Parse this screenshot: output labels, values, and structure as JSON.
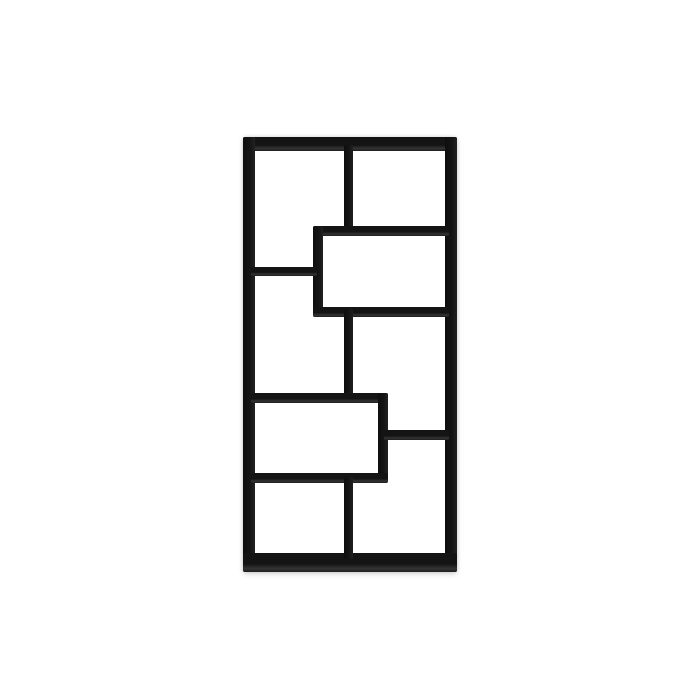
{
  "scene": {
    "type": "product-photo",
    "subject": "Black staggered geometric 8-compartment bookcase, front view, on plain white background",
    "background_color": "#ffffff",
    "frame_color": "#141414",
    "frame_lip_color": "#343434",
    "shadow_color": "rgba(0,0,0,0.18)"
  },
  "bookshelf": {
    "x": 243,
    "y": 137,
    "width": 214,
    "height": 435,
    "bars": [
      {
        "name": "frame-top",
        "x": 0,
        "y": 0,
        "w": 214,
        "h": 14
      },
      {
        "name": "frame-left",
        "x": 0,
        "y": 0,
        "w": 12,
        "h": 435
      },
      {
        "name": "frame-right",
        "x": 202,
        "y": 0,
        "w": 12,
        "h": 435
      },
      {
        "name": "frame-bottom",
        "x": 0,
        "y": 416,
        "w": 214,
        "h": 19
      },
      {
        "name": "divider-upper",
        "x": 101,
        "y": 8,
        "w": 9,
        "h": 91
      },
      {
        "name": "upper-box-top",
        "x": 70,
        "y": 89,
        "w": 136,
        "h": 10
      },
      {
        "name": "upper-box-left-wall",
        "x": 70,
        "y": 89,
        "w": 10,
        "h": 91
      },
      {
        "name": "upper-box-bottom",
        "x": 70,
        "y": 170,
        "w": 136,
        "h": 10
      },
      {
        "name": "shelf-left",
        "x": 8,
        "y": 130,
        "w": 66,
        "h": 9
      },
      {
        "name": "divider-middle",
        "x": 101,
        "y": 172,
        "w": 9,
        "h": 91
      },
      {
        "name": "lower-box-top",
        "x": 8,
        "y": 256,
        "w": 137,
        "h": 10
      },
      {
        "name": "lower-box-right-wall",
        "x": 135,
        "y": 256,
        "w": 10,
        "h": 90
      },
      {
        "name": "lower-box-bottom",
        "x": 8,
        "y": 336,
        "w": 137,
        "h": 10
      },
      {
        "name": "shelf-right",
        "x": 141,
        "y": 293,
        "w": 65,
        "h": 10
      },
      {
        "name": "divider-lower",
        "x": 101,
        "y": 340,
        "w": 9,
        "h": 82
      }
    ]
  }
}
